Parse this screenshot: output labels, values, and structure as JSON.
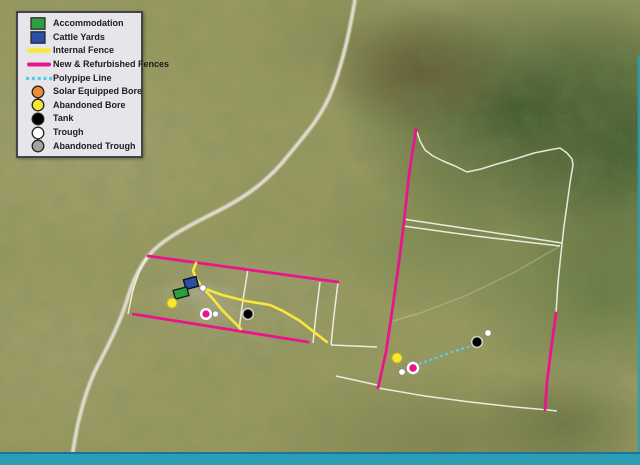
{
  "map": {
    "type": "aerial-property-map",
    "legend": {
      "items": [
        {
          "label": "Accommodation",
          "swatch": "square",
          "color": "#2f9e41"
        },
        {
          "label": "Cattle Yards",
          "swatch": "square",
          "color": "#2b4fa5"
        },
        {
          "label": "Internal Fence",
          "swatch": "line",
          "color": "#f7e93c"
        },
        {
          "label": "New & Refurbished Fences",
          "swatch": "line",
          "color": "#e8158c"
        },
        {
          "label": "Polypipe Line",
          "swatch": "dashed-line",
          "color": "#5ec8e8"
        },
        {
          "label": "Solar Equipped Bore",
          "swatch": "circle",
          "color": "#ef8b33"
        },
        {
          "label": "Abandoned Bore",
          "swatch": "circle",
          "color": "#f5e82e"
        },
        {
          "label": "Tank",
          "swatch": "circle",
          "color": "#000000"
        },
        {
          "label": "Trough",
          "swatch": "circle",
          "color": "#ffffff"
        },
        {
          "label": "Abandoned Trough",
          "swatch": "circle",
          "color": "#a3a3a3"
        }
      ]
    },
    "colors": {
      "accommodation": "#2f9e41",
      "cattle_yards": "#2b4fa5",
      "internal_fence": "#f7e93c",
      "new_fence": "#e8158c",
      "polypipe": "#5ec8e8",
      "solar_bore": "#ef8b33",
      "abandoned_bore": "#f5e82e",
      "tank": "#000000",
      "trough": "#ffffff",
      "abandoned_trough": "#a3a3a3",
      "bore_highlight": "#e8158c",
      "road": "#ddd8c9",
      "white_fence": "#f5f2e6",
      "footer_bar": "#2a9fb4",
      "footer_line": "#1a72a6",
      "swatch_outline": "#222222"
    },
    "features": {
      "markers": [
        {
          "type": "cattle-yards",
          "x": 191,
          "y": 283
        },
        {
          "type": "accommodation",
          "x": 181,
          "y": 293
        },
        {
          "type": "abandoned-bore",
          "x": 172,
          "y": 303
        },
        {
          "type": "trough",
          "x": 203,
          "y": 288
        },
        {
          "type": "bore-pink",
          "x": 206,
          "y": 314
        },
        {
          "type": "trough",
          "x": 215,
          "y": 314
        },
        {
          "type": "tank",
          "x": 248,
          "y": 314
        },
        {
          "type": "abandoned-bore",
          "x": 397,
          "y": 358
        },
        {
          "type": "trough",
          "x": 402,
          "y": 372
        },
        {
          "type": "bore-pink",
          "x": 413,
          "y": 368
        },
        {
          "type": "tank",
          "x": 477,
          "y": 342
        },
        {
          "type": "trough",
          "x": 488,
          "y": 333
        }
      ],
      "lines": [
        {
          "type": "road"
        },
        {
          "type": "new-refurbished-fence",
          "count": 4
        },
        {
          "type": "internal-fence",
          "count": 3
        },
        {
          "type": "white-fence",
          "count": 11
        },
        {
          "type": "polypipe-line",
          "count": 1
        }
      ]
    }
  }
}
